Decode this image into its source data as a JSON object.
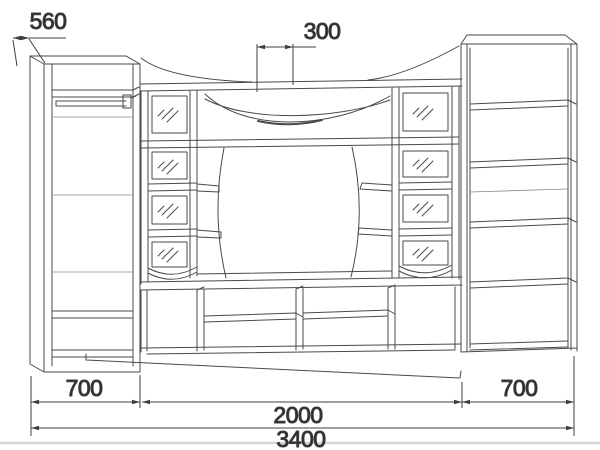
{
  "drawing": {
    "type": "furniture technical drawing",
    "dimensions": {
      "depth": "560",
      "top_offset": "300",
      "left_width": "700",
      "center_width": "2000",
      "right_width": "700",
      "total_width": "3400"
    }
  },
  "colors": {
    "line": "#4a4a4a",
    "dimension_line": "#3f3f3f",
    "text": "#2a2a2a",
    "floor_line": "#d4d4d4",
    "background": "#ffffff"
  }
}
